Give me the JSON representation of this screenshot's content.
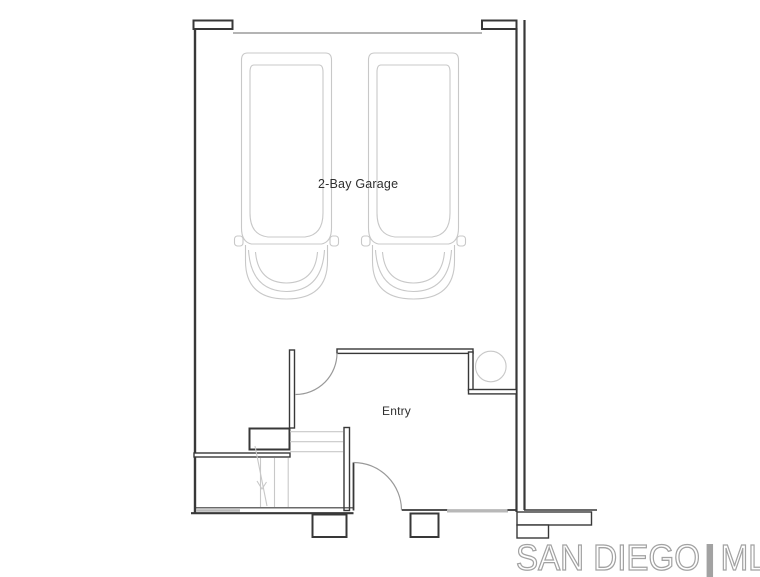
{
  "labels": {
    "garage": "2-Bay Garage",
    "entry": "Entry"
  },
  "watermark": {
    "left": "SAN DIEGO",
    "separator": "|",
    "right": "MLS"
  },
  "colors": {
    "wall": "#383838",
    "light": "#c8c8c8",
    "medium": "#9c9c9c",
    "window": "#b8b8b8",
    "door": "#999999",
    "watermark": "#a2a2a2",
    "text": "#2f2f2f",
    "background": "#ffffff"
  }
}
